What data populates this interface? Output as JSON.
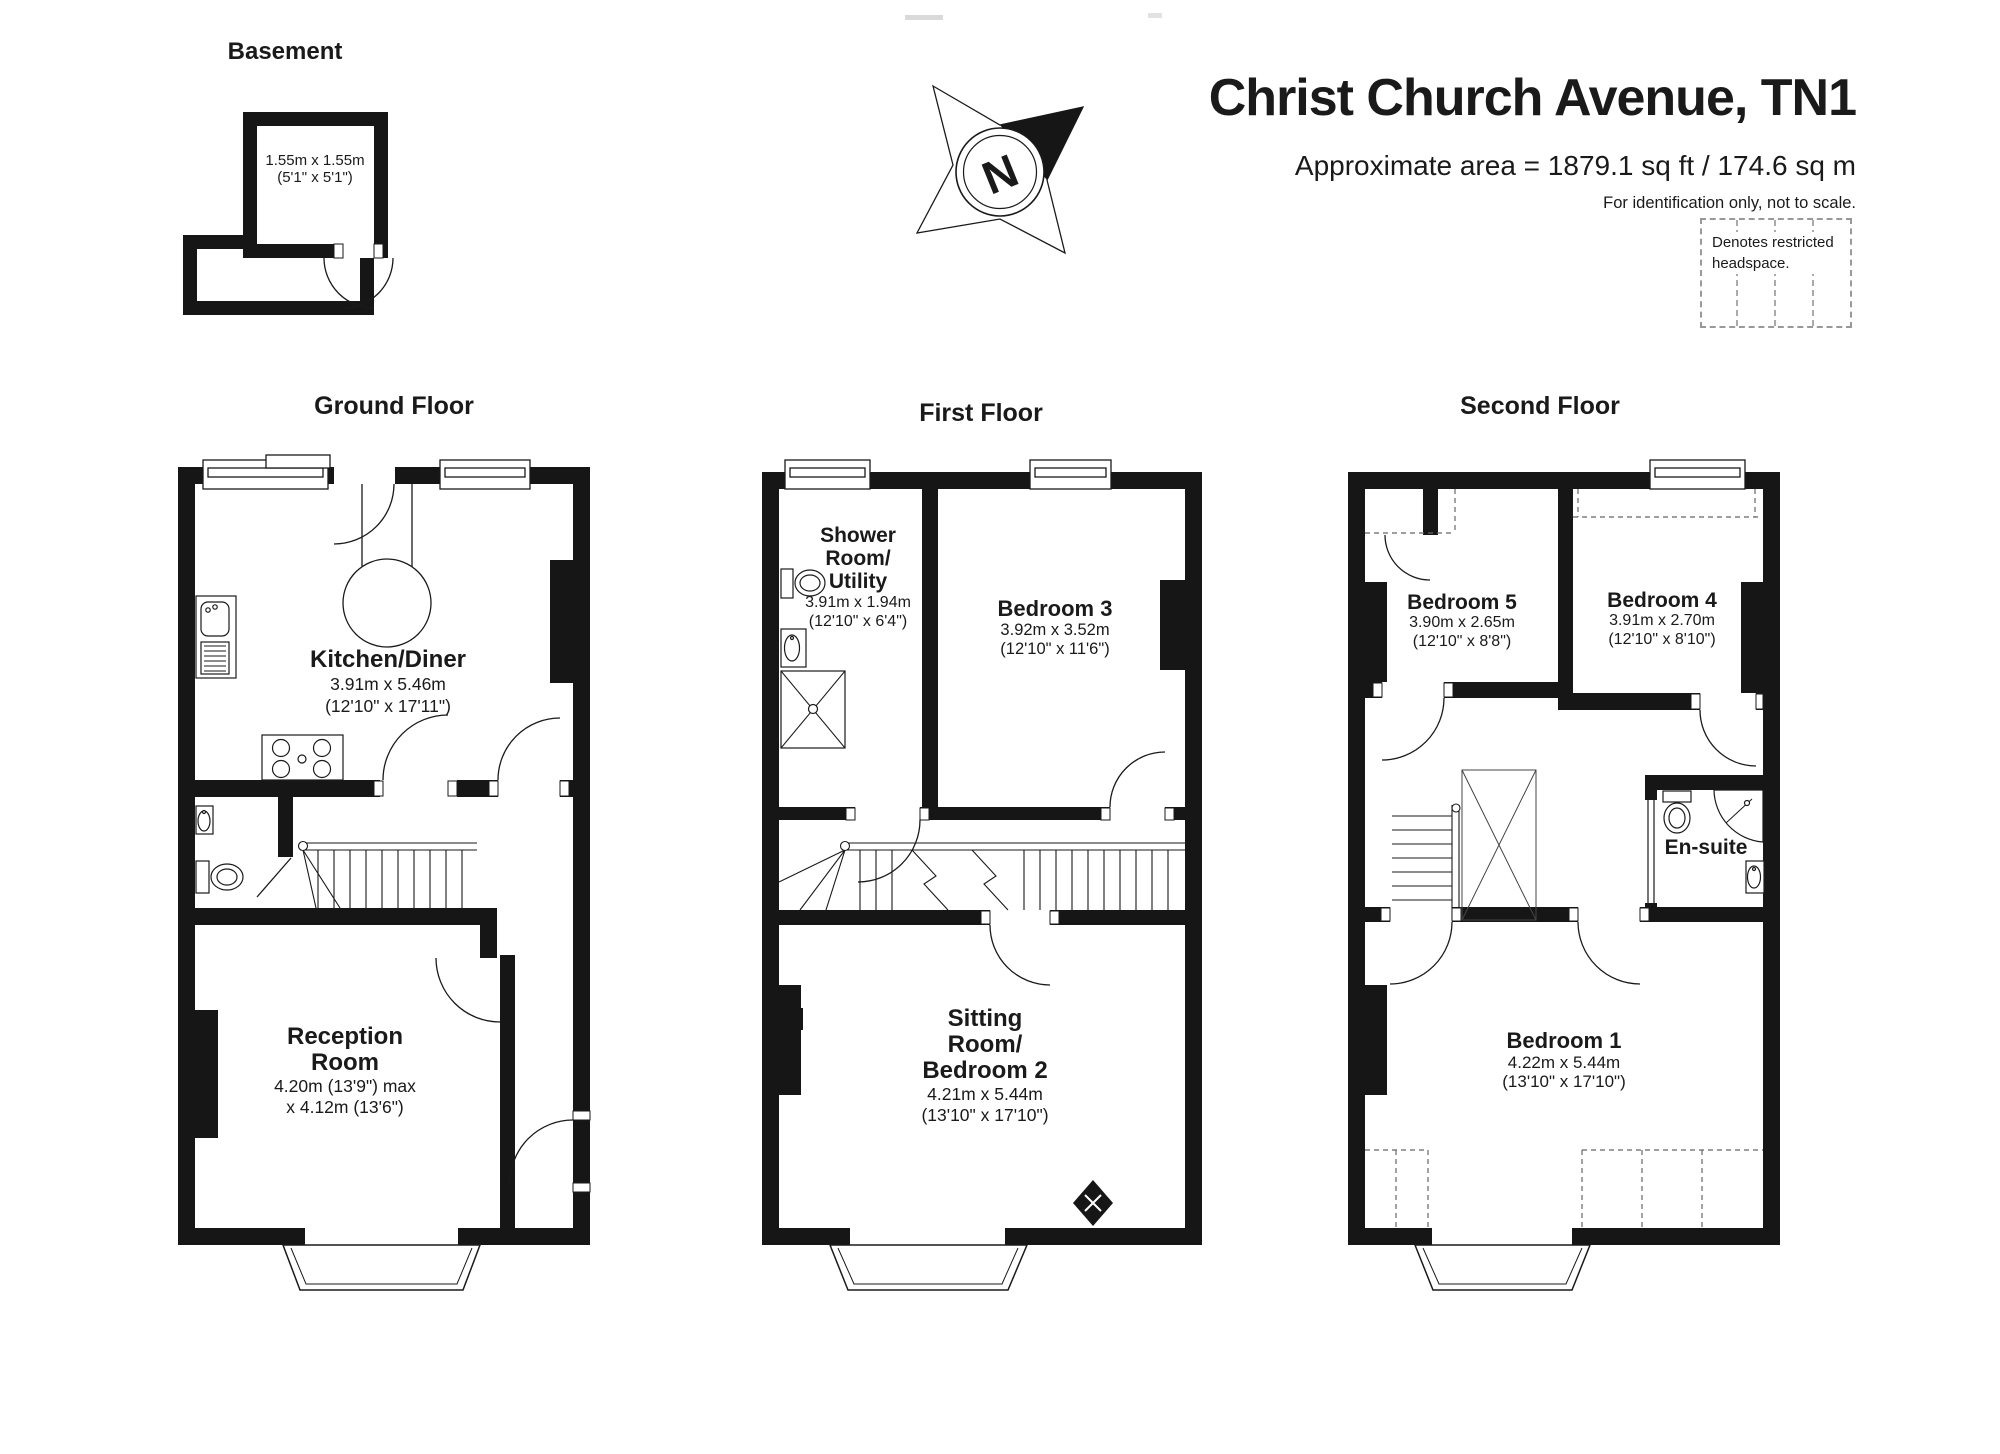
{
  "header": {
    "title": "Christ Church Avenue, TN1",
    "area_line": "Approximate area = 1879.1 sq ft / 174.6 sq m",
    "note": "For identification only, not to scale.",
    "legend_line1": "Denotes restricted",
    "legend_line2": "headspace."
  },
  "compass": {
    "north_label": "N"
  },
  "basement": {
    "label": "Basement",
    "dims_m": "1.55m x 1.55m",
    "dims_ft": "(5'1\" x 5'1\")"
  },
  "ground": {
    "label": "Ground Floor",
    "kitchen_name": "Kitchen/Diner",
    "kitchen_dims_m": "3.91m x 5.46m",
    "kitchen_dims_ft": "(12'10\" x 17'11\")",
    "reception_line1": "Reception",
    "reception_line2": "Room",
    "reception_dims_m": "4.20m (13'9\") max",
    "reception_dims_ft": "x 4.12m (13'6\")"
  },
  "first": {
    "label": "First Floor",
    "shower_line1": "Shower",
    "shower_line2": "Room/",
    "shower_line3": "Utility",
    "shower_dims_m": "3.91m x 1.94m",
    "shower_dims_ft": "(12'10\" x 6'4\")",
    "bedroom3_name": "Bedroom 3",
    "bedroom3_dims_m": "3.92m x 3.52m",
    "bedroom3_dims_ft": "(12'10\" x 11'6\")",
    "sitting_line1": "Sitting",
    "sitting_line2": "Room/",
    "sitting_line3": "Bedroom 2",
    "sitting_dims_m": "4.21m x 5.44m",
    "sitting_dims_ft": "(13'10\" x 17'10\")"
  },
  "second": {
    "label": "Second Floor",
    "bedroom5_name": "Bedroom 5",
    "bedroom5_dims_m": "3.90m x 2.65m",
    "bedroom5_dims_ft": "(12'10\" x 8'8\")",
    "bedroom4_name": "Bedroom 4",
    "bedroom4_dims_m": "3.91m x 2.70m",
    "bedroom4_dims_ft": "(12'10\" x 8'10\")",
    "ensuite_name": "En-suite",
    "bedroom1_name": "Bedroom 1",
    "bedroom1_dims_m": "4.22m x 5.44m",
    "bedroom1_dims_ft": "(13'10\" x 17'10\")"
  }
}
